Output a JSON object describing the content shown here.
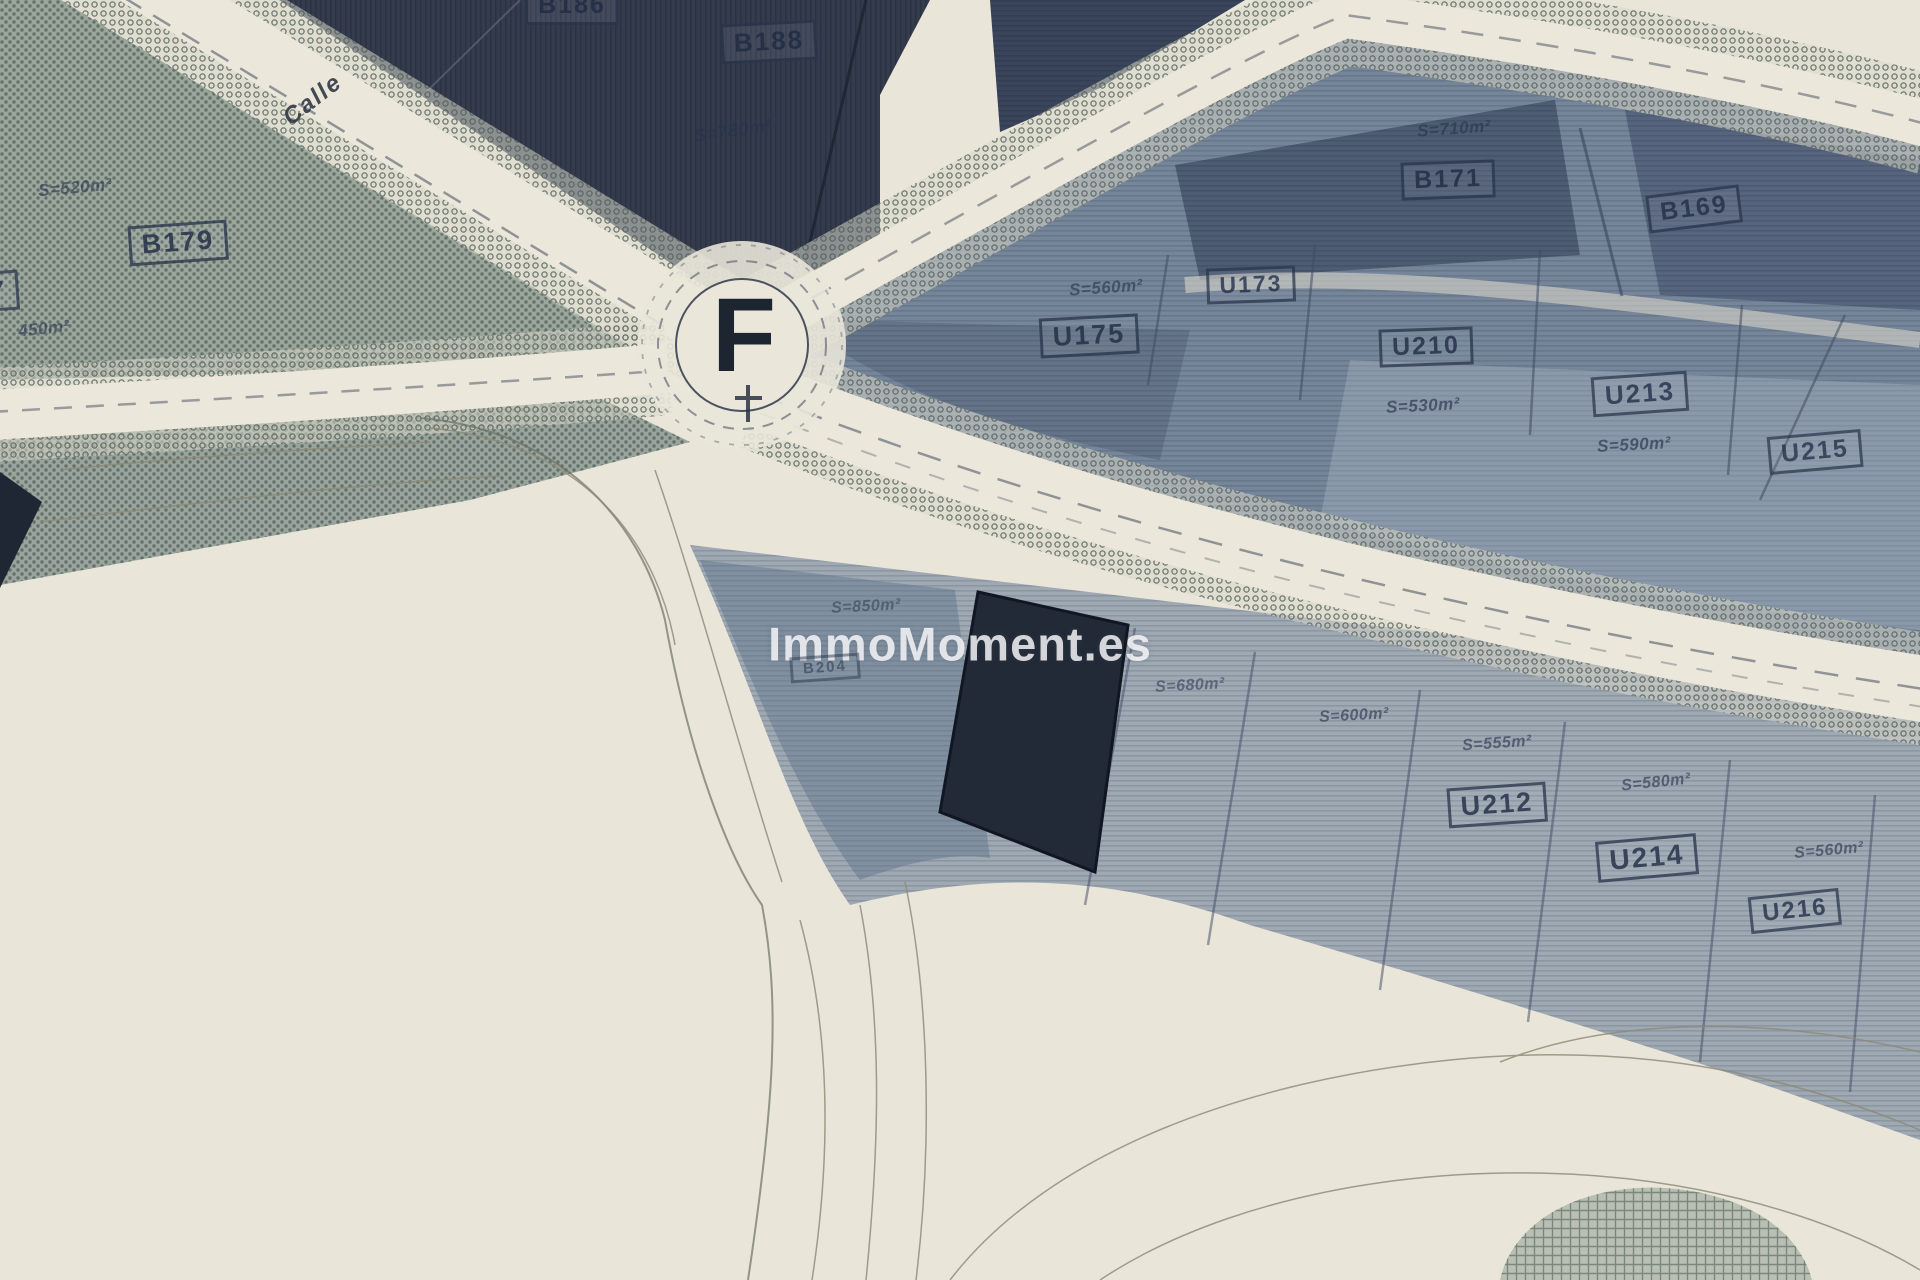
{
  "map": {
    "type": "cadastral-plot-plan-photo",
    "watermark": {
      "text": "ImmoMoment.es"
    },
    "roundabout": {
      "letter": "F"
    },
    "street": {
      "name": "Calle"
    },
    "colors": {
      "paper_road": "#e9e5d9",
      "block_dark_navy": "#333b4d",
      "block_slate": "#75859a",
      "block_light_slate": "#9fa9b4",
      "block_hatch_green": "#9aa59b",
      "selected_plot": "#222a37",
      "label_ink": "#27334a",
      "watermark_color": "#fafafd"
    },
    "labels": [
      {
        "id": "plot-b186",
        "text": "B186",
        "style": "boxed",
        "x": 572,
        "y": 6,
        "rot": 0,
        "size": 25,
        "op": 0.9
      },
      {
        "id": "plot-b188",
        "text": "B188",
        "style": "boxed",
        "x": 769,
        "y": 42,
        "rot": -3,
        "size": 26,
        "op": 0.9
      },
      {
        "id": "area-b188",
        "text": "S=780m²",
        "style": "hand",
        "x": 733,
        "y": 131,
        "rot": -8,
        "size": 18,
        "op": 0.85
      },
      {
        "id": "area-b179",
        "text": "S=520m²",
        "style": "hand",
        "x": 75,
        "y": 188,
        "rot": -5,
        "size": 17,
        "op": 0.8
      },
      {
        "id": "plot-b179",
        "text": "B179",
        "style": "boxed",
        "x": 178,
        "y": 243,
        "rot": -4,
        "size": 27,
        "op": 0.9
      },
      {
        "id": "plot-left-partial",
        "text": "7",
        "style": "boxed",
        "x": -2,
        "y": 291,
        "rot": -4,
        "size": 26,
        "op": 0.85
      },
      {
        "id": "area-left",
        "text": "450m²",
        "style": "hand",
        "x": 44,
        "y": 329,
        "rot": -6,
        "size": 17,
        "op": 0.8
      },
      {
        "id": "area-u175",
        "text": "S=560m²",
        "style": "hand",
        "x": 1106,
        "y": 288,
        "rot": -4,
        "size": 17,
        "op": 0.8
      },
      {
        "id": "plot-u175",
        "text": "U175",
        "style": "boxed",
        "x": 1089,
        "y": 336,
        "rot": -3,
        "size": 27,
        "op": 0.88
      },
      {
        "id": "plot-u173",
        "text": "U173",
        "style": "boxed",
        "x": 1251,
        "y": 285,
        "rot": -2,
        "size": 23,
        "op": 0.85
      },
      {
        "id": "area-b171",
        "text": "S=710m²",
        "style": "hand",
        "x": 1454,
        "y": 129,
        "rot": -4,
        "size": 17,
        "op": 0.8
      },
      {
        "id": "plot-b171",
        "text": "B171",
        "style": "boxed",
        "x": 1448,
        "y": 180,
        "rot": -2,
        "size": 25,
        "op": 0.88
      },
      {
        "id": "plot-b169",
        "text": "B169",
        "style": "boxed",
        "x": 1694,
        "y": 209,
        "rot": -7,
        "size": 25,
        "op": 0.85
      },
      {
        "id": "plot-u210",
        "text": "U210",
        "style": "boxed",
        "x": 1426,
        "y": 347,
        "rot": -2,
        "size": 25,
        "op": 0.88
      },
      {
        "id": "area-u210",
        "text": "S=530m²",
        "style": "hand",
        "x": 1423,
        "y": 406,
        "rot": -3,
        "size": 17,
        "op": 0.85
      },
      {
        "id": "plot-u213",
        "text": "U213",
        "style": "boxed",
        "x": 1640,
        "y": 394,
        "rot": -4,
        "size": 26,
        "op": 0.85
      },
      {
        "id": "area-u213",
        "text": "S=590m²",
        "style": "hand",
        "x": 1634,
        "y": 445,
        "rot": -3,
        "size": 17,
        "op": 0.85
      },
      {
        "id": "plot-u215",
        "text": "U215",
        "style": "boxed",
        "x": 1815,
        "y": 452,
        "rot": -5,
        "size": 25,
        "op": 0.82
      },
      {
        "id": "area-b204",
        "text": "S=850m²",
        "style": "hand",
        "x": 866,
        "y": 607,
        "rot": -3,
        "size": 16,
        "op": 0.65
      },
      {
        "id": "plot-b204",
        "text": "B204",
        "style": "boxed",
        "x": 825,
        "y": 668,
        "rot": -4,
        "size": 15,
        "op": 0.55
      },
      {
        "id": "area-road-1",
        "text": "S=680m²",
        "style": "hand",
        "x": 1190,
        "y": 686,
        "rot": -3,
        "size": 16,
        "op": 0.7
      },
      {
        "id": "area-road-2",
        "text": "S=600m²",
        "style": "hand",
        "x": 1354,
        "y": 716,
        "rot": -3,
        "size": 16,
        "op": 0.8
      },
      {
        "id": "area-u212",
        "text": "S=555m²",
        "style": "hand",
        "x": 1497,
        "y": 744,
        "rot": -4,
        "size": 16,
        "op": 0.8
      },
      {
        "id": "plot-u212",
        "text": "U212",
        "style": "boxed",
        "x": 1497,
        "y": 805,
        "rot": -4,
        "size": 27,
        "op": 0.88
      },
      {
        "id": "area-u214",
        "text": "S=580m²",
        "style": "hand",
        "x": 1656,
        "y": 783,
        "rot": -6,
        "size": 16,
        "op": 0.8
      },
      {
        "id": "plot-u214",
        "text": "U214",
        "style": "boxed",
        "x": 1647,
        "y": 858,
        "rot": -5,
        "size": 28,
        "op": 0.88
      },
      {
        "id": "area-u216",
        "text": "S=560m²",
        "style": "hand",
        "x": 1829,
        "y": 851,
        "rot": -5,
        "size": 16,
        "op": 0.8
      },
      {
        "id": "plot-u216",
        "text": "U216",
        "style": "boxed",
        "x": 1795,
        "y": 911,
        "rot": -6,
        "size": 24,
        "op": 0.85
      }
    ]
  }
}
